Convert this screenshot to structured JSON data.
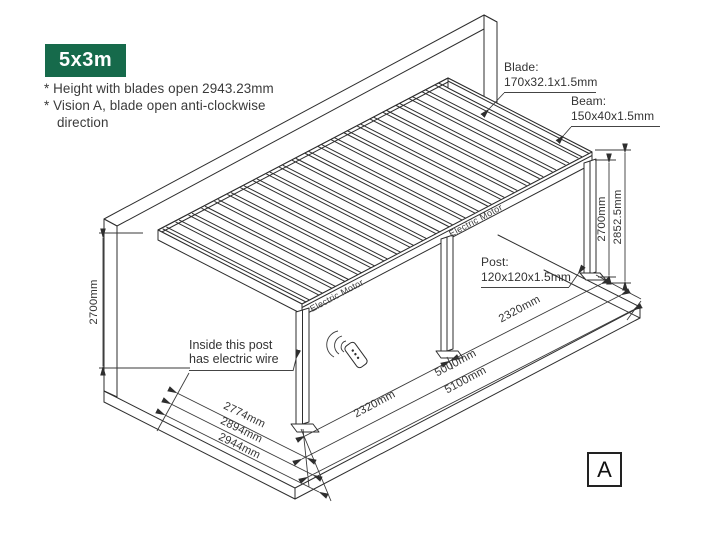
{
  "badge": {
    "label": "5x3m",
    "bg": "#166a4b"
  },
  "notes": {
    "line1": "* Height with blades open 2943.23mm",
    "line2": "* Vision A, blade open anti-clockwise",
    "line3": "direction"
  },
  "callouts": {
    "blade": {
      "title": "Blade:",
      "spec": "170x32.1x1.5mm"
    },
    "beam": {
      "title": "Beam:",
      "spec": "150x40x1.5mm"
    },
    "post": {
      "title": "Post:",
      "spec": "120x120x1.5mm"
    },
    "inside_post": {
      "line1": "Inside this post",
      "line2": "has electric wire"
    }
  },
  "dimensions": {
    "left_height": "2700mm",
    "right_height_post": "2700mm",
    "right_height_total": "2852.5mm",
    "front_span_left": "2320mm",
    "front_span_right": "2320mm",
    "front_length": "5000mm",
    "front_length_total": "5100mm",
    "depth_clear": "2774mm",
    "depth_post": "2894mm",
    "depth_total": "2944mm"
  },
  "labels": {
    "electric_motor_1": "Electric Motor",
    "electric_motor_2": "Electric Motor",
    "vision_marker": "A"
  }
}
